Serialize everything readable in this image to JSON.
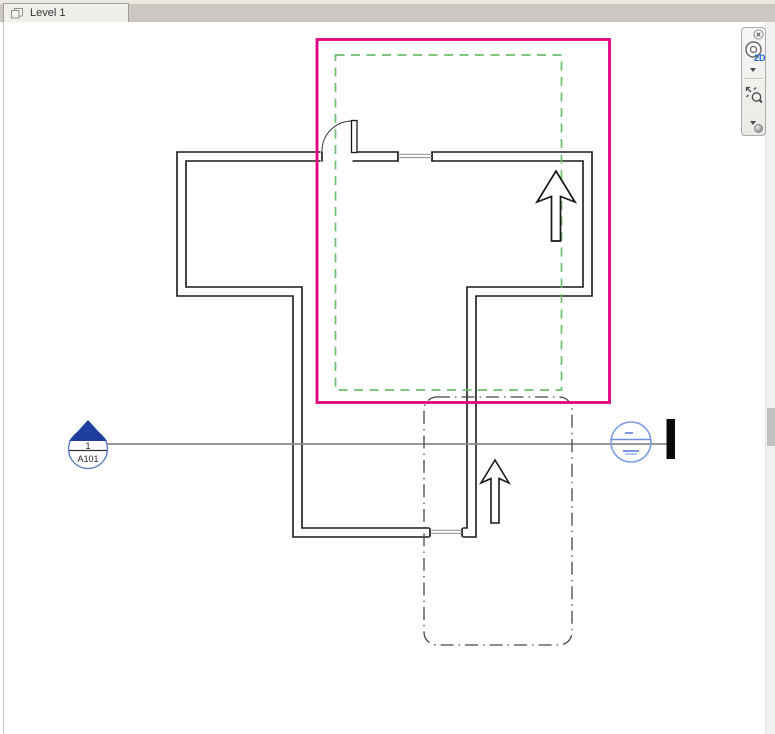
{
  "tab_bar": {
    "active_tab": {
      "label": "Level 1"
    }
  },
  "navigation_bar": {
    "wheel_badge": "2D"
  },
  "drawing": {
    "section_marker": {
      "detail_number": "1",
      "sheet_number": "A101"
    },
    "grid_bubble": {
      "top_dash": "-",
      "bottom_dash": "-"
    },
    "colors": {
      "wall": "#1A1A1A",
      "crop_region": "#E0007F",
      "annotation_crop": "#6FBE6F",
      "scope_outline": "#474747",
      "section_line": "#8A8A8A",
      "section_head_fill": "#1E3E9E",
      "section_head_ring": "#5A74C4",
      "section_marker_text": "#20242E",
      "grid_bubble_blue": "#7E9BE3",
      "north_arrow_outline": "#1A1A1A"
    }
  }
}
